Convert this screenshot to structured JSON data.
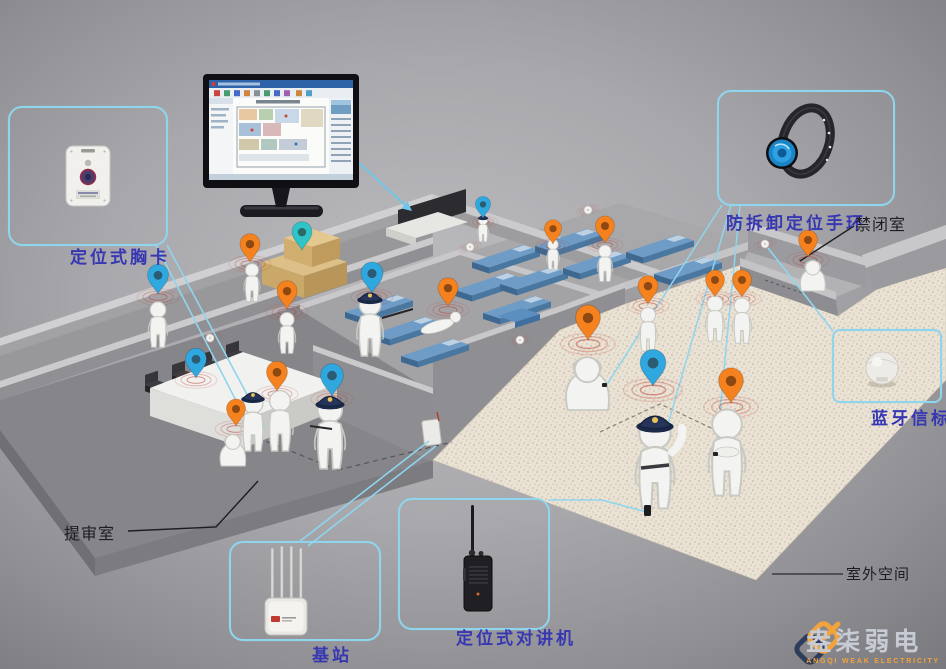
{
  "scene": {
    "type": "isometric-positioning-system-diagram"
  },
  "callouts": {
    "badge": {
      "label": "定位式胸卡",
      "device": "badge-tag"
    },
    "wristband": {
      "label": "防拆卸定位手环",
      "device": "anti-tamper-wristband"
    },
    "beacon": {
      "label": "蓝牙信标",
      "device": "bluetooth-beacon"
    },
    "base_station": {
      "label": "基站",
      "device": "base-station"
    },
    "walkie_talkie": {
      "label": "定位式对讲机",
      "device": "walkie-talkie"
    }
  },
  "rooms": {
    "confinement": {
      "label": "禁闭室"
    },
    "interrogation": {
      "label": "提审室"
    },
    "outdoor": {
      "label": "室外空间"
    }
  },
  "logo": {
    "name": "盎柒弱电",
    "subtitle": "ANGQI WEAK ELECTRICITY"
  },
  "colors": {
    "accent_cyan": "#8fd5ee",
    "label_blue": "#3737b2",
    "pin_orange": "#f5821f",
    "pin_blue": "#2fa8e0",
    "pin_teal": "#2fc4c8",
    "ripple_red": "#c0392b",
    "outdoor_ground": "#e9e2d6",
    "logo_orange": "#f2a33c",
    "logo_navy": "#2e3d5c"
  },
  "icons": [
    "location-pin-orange",
    "location-pin-blue",
    "location-pin-teal",
    "signal-ripple",
    "wall-beacon",
    "monitor-screen",
    "arrow-pointer"
  ]
}
